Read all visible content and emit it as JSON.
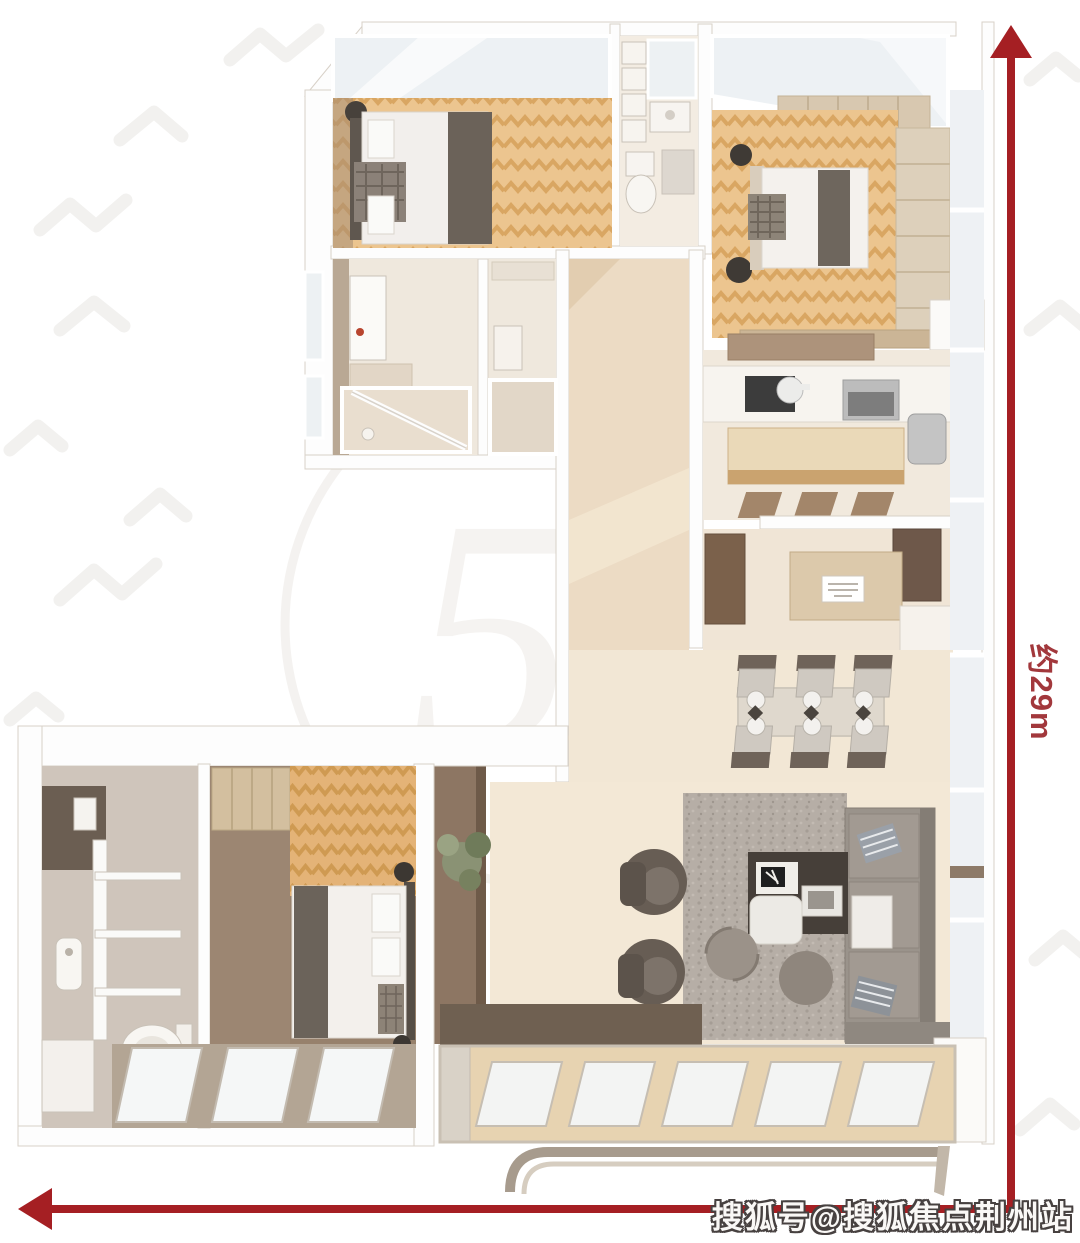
{
  "image": {
    "type": "3d-floor-plan-rendering",
    "width": 1080,
    "height": 1243
  },
  "colors": {
    "accent-red": "#a51f23",
    "dim-label-red": "#a2383c",
    "wall-white": "#fdfdfd",
    "wall-line": "#d8d1c8",
    "watermark-gray": "#f1efec"
  },
  "annotations": {
    "vertical_dimension_label": "约29m",
    "sohu_watermark": "搜狐号@搜狐焦点荆州站",
    "logo_watermark": "51"
  },
  "icons": {
    "vertical_arrow": "arrow-up-icon",
    "horizontal_arrow": "arrow-left-icon"
  },
  "floor_plan": {
    "rooms": [
      "bedroom-top-left",
      "bathroom-top",
      "master-bedroom",
      "bathroom-left",
      "hallway",
      "kitchen",
      "pantry",
      "dining-area",
      "living-room",
      "bathroom-bottom-left",
      "closet-bottom",
      "bedroom-bottom",
      "balcony"
    ],
    "furniture": [
      "double-bed",
      "double-bed",
      "single-bed",
      "dining-table-with-six-chairs",
      "corner-sofa",
      "coffee-table",
      "two-armchairs",
      "round-poufs",
      "kitchen-counter",
      "kitchen-island",
      "refrigerator",
      "sideboard",
      "wardrobe",
      "toilet",
      "bathtub",
      "washbasin",
      "potted-plant",
      "area-rug"
    ]
  }
}
